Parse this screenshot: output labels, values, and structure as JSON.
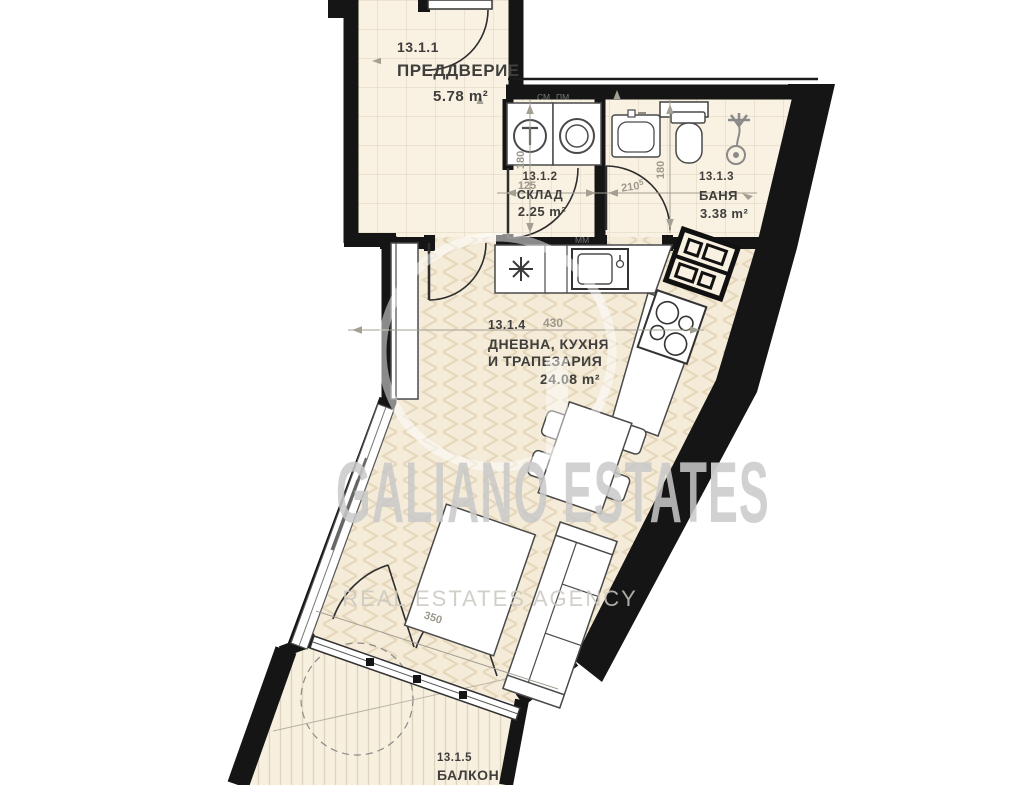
{
  "watermark": {
    "brand_part1": "GALIANO ESTAT",
    "brand_part2": "ES",
    "tagline": "REAL ESTATES AGENCY"
  },
  "rooms": {
    "hall": {
      "code": "13.1.1",
      "name": "ПРЕДДВЕРИЕ",
      "area": "5.78 m²"
    },
    "storage": {
      "code": "13.1.2",
      "name": "СКЛАД",
      "area": "2.25 m²"
    },
    "bath": {
      "code": "13.1.3",
      "name": "БАНЯ",
      "area": "3.38 m²"
    },
    "living": {
      "code": "13.1.4",
      "name_line1": "ДНЕВНА, КУХНЯ",
      "name_line2": "И ТРАПЕЗАРИЯ",
      "area": "24.08 m²"
    },
    "balcony": {
      "code": "13.1.5",
      "name": "БАЛКОН"
    }
  },
  "dimensions": {
    "storage_width": "125",
    "storage_depth": "180",
    "bath_width": "210",
    "bath_width_sup": "5",
    "bath_depth": "180",
    "living_width": "430",
    "balcony_door_width": "350"
  },
  "appliances": {
    "washing_machine_label": "СМ",
    "dishwasher_label": "ПМ",
    "kitchen_sink_label": "ММ"
  },
  "colors": {
    "wall": "#151515",
    "floor_cream": "#f8f1e1",
    "parquet_line": "#e5d6ba",
    "tile_line": "#ddd3bf",
    "dimension": "#a49f93",
    "label": "#3f3e3c",
    "watermark": "#c9c9c9"
  }
}
